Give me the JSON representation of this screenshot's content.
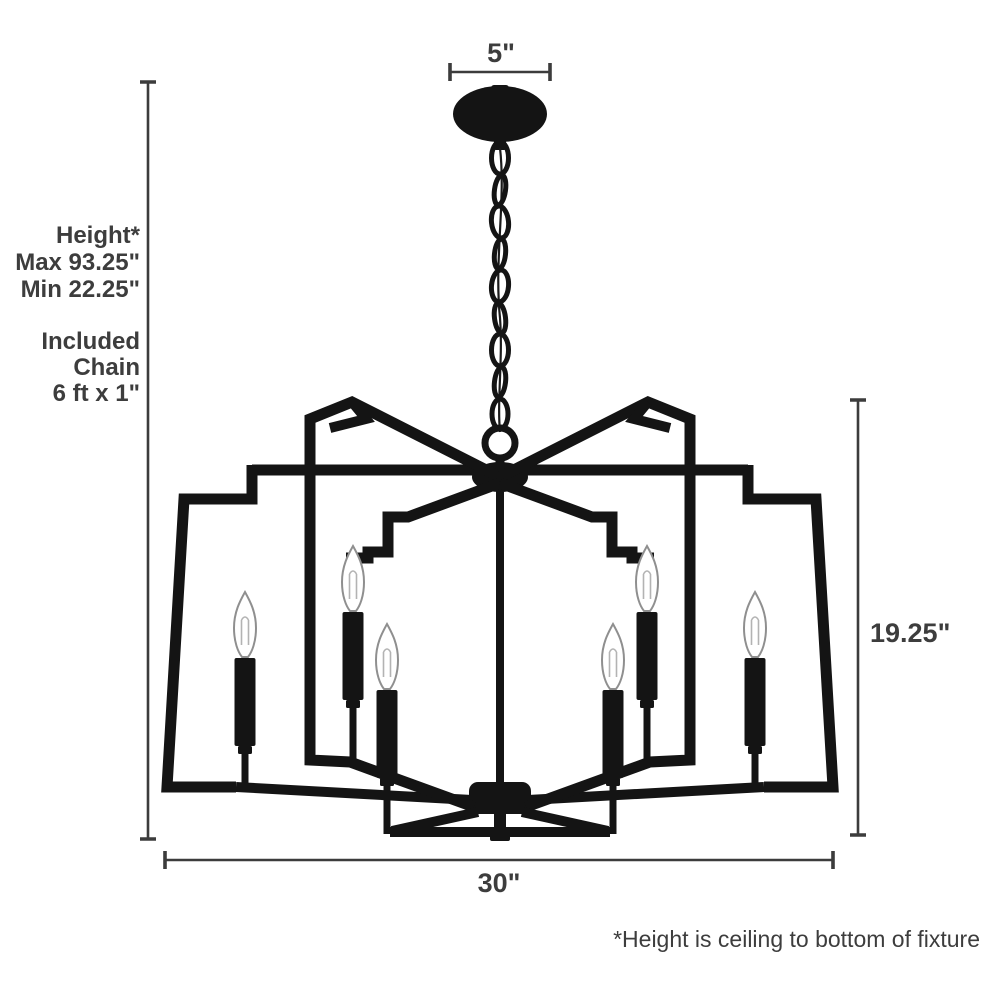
{
  "figure": {
    "type": "chandelier-dimension-diagram",
    "labels": {
      "canopy_width": "5\"",
      "fixture_width": "30\"",
      "fixture_height": "19.25\"",
      "height_title": "Height*",
      "height_max": "Max 93.25\"",
      "height_min": "Min 22.25\"",
      "chain_line1": "Included",
      "chain_line2": "Chain",
      "chain_line3": "6 ft x 1\"",
      "footnote": "*Height is ceiling to bottom of fixture"
    },
    "colors": {
      "metal": "#141414",
      "dimension_lines": "#3c3c3c",
      "text": "#3d3d3d",
      "background": "#ffffff",
      "bulb_outline": "#8f8f8f"
    }
  }
}
